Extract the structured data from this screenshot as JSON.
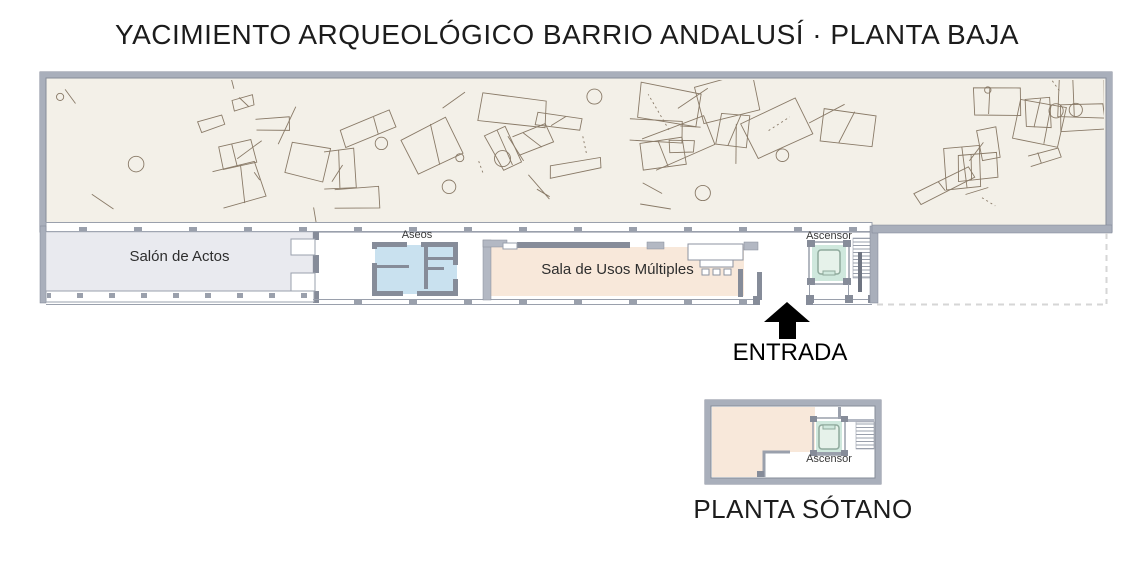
{
  "title": "YACIMIENTO ARQUEOLÓGICO BARRIO ANDALUSÍ · PLANTA BAJA",
  "ground_floor": {
    "name": "PLANTA BAJA",
    "archaeological_area": {
      "description_name": "yacimiento-arqueologico-ruins-plan"
    },
    "rooms": {
      "salon": {
        "label": "Salón de Actos"
      },
      "aseos": {
        "label": "Aseos"
      },
      "sala": {
        "label": "Sala de Usos Múltiples"
      },
      "ascensor": {
        "label": "Ascensor"
      }
    },
    "entrance_label": "ENTRADA"
  },
  "basement": {
    "label": "PLANTA SÓTANO",
    "rooms": {
      "ascensor": {
        "label": "Ascensor"
      }
    }
  },
  "colors": {
    "arch_bg": "#f3f0e8",
    "sketch": "#6f5d48",
    "wall": "#a9afbb",
    "wall_edge": "#7f8594",
    "wall_dark": "#868c99",
    "salon": "#e9eaef",
    "aseos": "#c9e1ef",
    "sala": "#f8e8da",
    "ascensor": "#cfe8dd",
    "dashed": "#d6d6d6",
    "arrow": "#000000"
  }
}
